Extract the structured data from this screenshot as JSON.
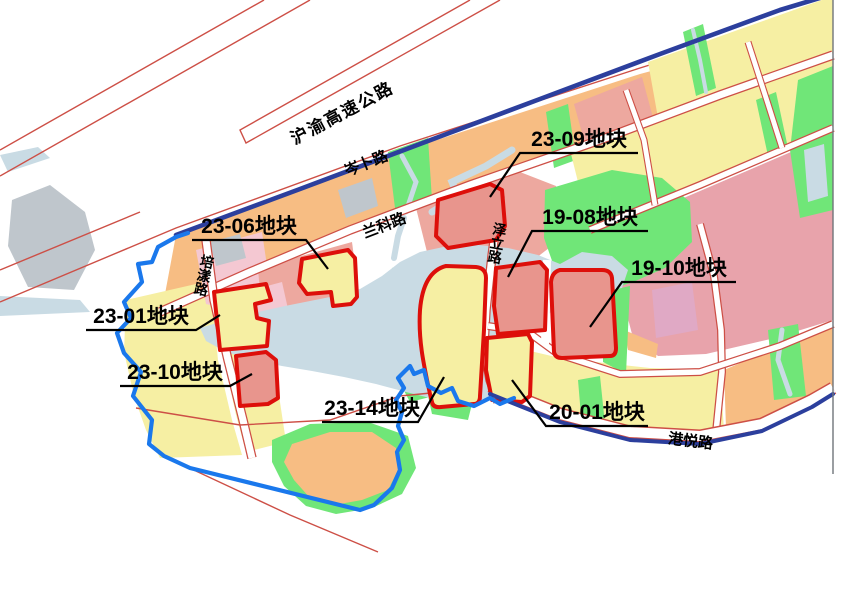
{
  "map": {
    "type": "urban-planning-parcel-map",
    "roads": {
      "expressway": {
        "label": "沪渝高速公路"
      },
      "cenbu": {
        "label": "岑卜路"
      },
      "lanke": {
        "label": "兰科路"
      },
      "zeli": {
        "label": "泽立路"
      },
      "peiyang": {
        "label": "培漾路"
      },
      "gangyue": {
        "label": "港悦路"
      }
    },
    "parcels": {
      "p2309": {
        "id": "23-09",
        "label": "23-09地块",
        "fill": "pink"
      },
      "p1908": {
        "id": "19-08",
        "label": "19-08地块",
        "fill": "pink"
      },
      "p1910": {
        "id": "19-10",
        "label": "19-10地块",
        "fill": "pink"
      },
      "p2306": {
        "id": "23-06",
        "label": "23-06地块",
        "fill": "yellow"
      },
      "p2301": {
        "id": "23-01",
        "label": "23-01地块",
        "fill": "yellow"
      },
      "p2310": {
        "id": "23-10",
        "label": "23-10地块",
        "fill": "pink"
      },
      "p2314": {
        "id": "23-14",
        "label": "23-14地块",
        "fill": "yellow"
      },
      "p2001": {
        "id": "20-01",
        "label": "20-01地块",
        "fill": "yellow"
      }
    },
    "colors": {
      "parcel_outline_red": "#dd0f0a",
      "boundary_blue": "#1a78ec",
      "road_line_blue": "#2c3f9d",
      "road_edge_red": "#cd4f46",
      "yellow_parcel": "#f6efa3",
      "orange_parcel": "#f7bd83",
      "pink_parcel": "#e8958d",
      "pink_surround": "#eda89f",
      "big_pink_block": "#e8a3ab",
      "pink_patch": "#e0a9c5",
      "light_pink": "#f4c8d2",
      "green_space": "#70e678",
      "water_blue": "#c9dbe4",
      "gray_parcel": "#bfc6cc",
      "frame_gray": "#70757a",
      "label_black": "#000000"
    }
  }
}
